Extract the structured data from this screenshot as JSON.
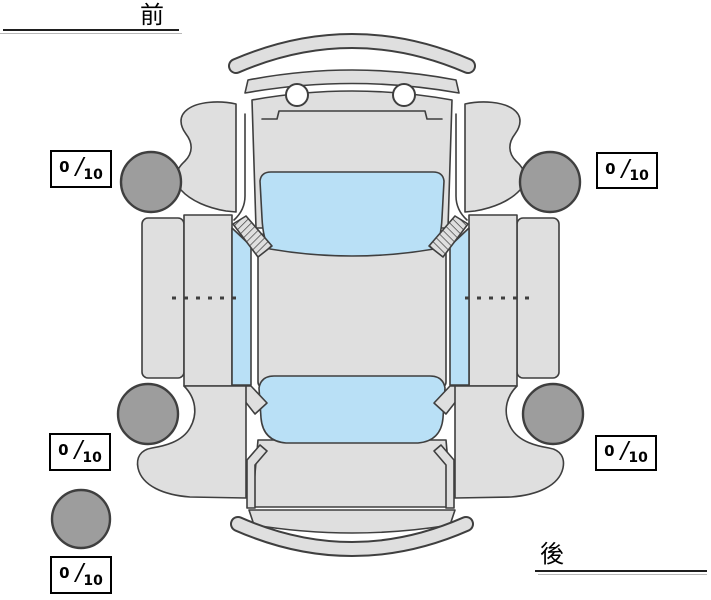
{
  "diagram": {
    "orientation": {
      "front_label": "前",
      "rear_label": "後"
    },
    "tires": {
      "front_left": {
        "value": "0",
        "separator": "/",
        "max": "10"
      },
      "front_right": {
        "value": "0",
        "separator": "/",
        "max": "10"
      },
      "rear_left": {
        "value": "0",
        "separator": "/",
        "max": "10"
      },
      "rear_right": {
        "value": "0",
        "separator": "/",
        "max": "10"
      },
      "spare": {
        "value": "0",
        "separator": "/",
        "max": "10"
      }
    },
    "colors": {
      "background": "#ffffff",
      "car_body": "#dfdfdf",
      "outline": "#3f3f3f",
      "windows": "#b9e0f6",
      "tires": "#9d9d9d",
      "box_border": "#000000",
      "text": "#000000"
    }
  }
}
